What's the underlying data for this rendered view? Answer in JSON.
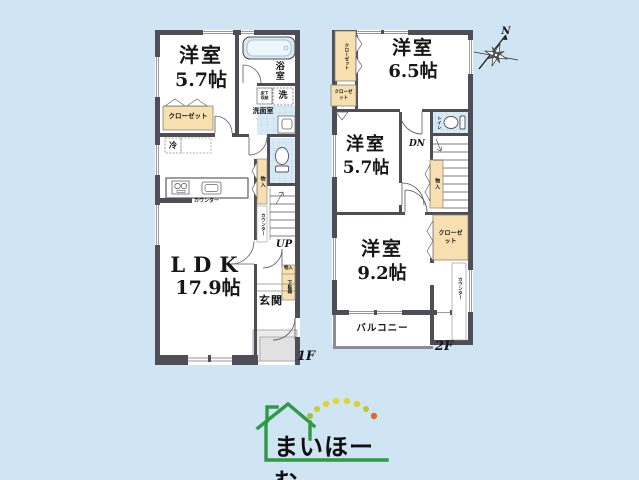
{
  "colors": {
    "background": "#cfe5f3",
    "wall": "#4e4e56",
    "closet_fill": "#f7dfb0",
    "water_tile": "#d7eaf5",
    "logo_green": "#2e9a44",
    "logo_text": "#101010"
  },
  "floor1": {
    "floor_label": "1F",
    "bedroom": {
      "name": "洋室",
      "size": "5.7帖"
    },
    "ldk": {
      "name": "LDK",
      "size": "17.9帖"
    },
    "bath_label": "浴室",
    "washer_label": "洗",
    "washroom_label": "洗面室",
    "floor_storage_label": "床下収納",
    "closet_label": "クローゼット",
    "fridge_label": "冷",
    "kitchen_counter_label": "カウンター",
    "hall_storage_label": "物入",
    "hall_counter_label": "カウンター",
    "stairs_label": "UP",
    "entrance_label": "玄関",
    "shoe_box_top_label": "物入",
    "shoe_box_label": "下駄箱"
  },
  "floor2": {
    "floor_label": "2F",
    "bedroom_a": {
      "name": "洋室",
      "size": "6.5帖"
    },
    "bedroom_b": {
      "name": "洋室",
      "size": "5.7帖"
    },
    "bedroom_c": {
      "name": "洋室",
      "size": "9.2帖"
    },
    "closet_a_label": "クローゼット",
    "closet_b_label": "クローゼット",
    "closet_c_label": "クローゼット",
    "toilet_label": "トイレ",
    "stairs_label": "DN",
    "storage_label": "物入",
    "counter_label": "カウンター",
    "balcony_label": "バルコニー"
  },
  "compass": {
    "north_label": "N"
  },
  "logo": {
    "text": "まいほーむ",
    "dot_colors": [
      "#a6bf3b",
      "#c6ce32",
      "#e0d52d",
      "#e5d92a",
      "#e2d62c",
      "#d6d22f",
      "#bcc936",
      "#de6a27"
    ]
  }
}
